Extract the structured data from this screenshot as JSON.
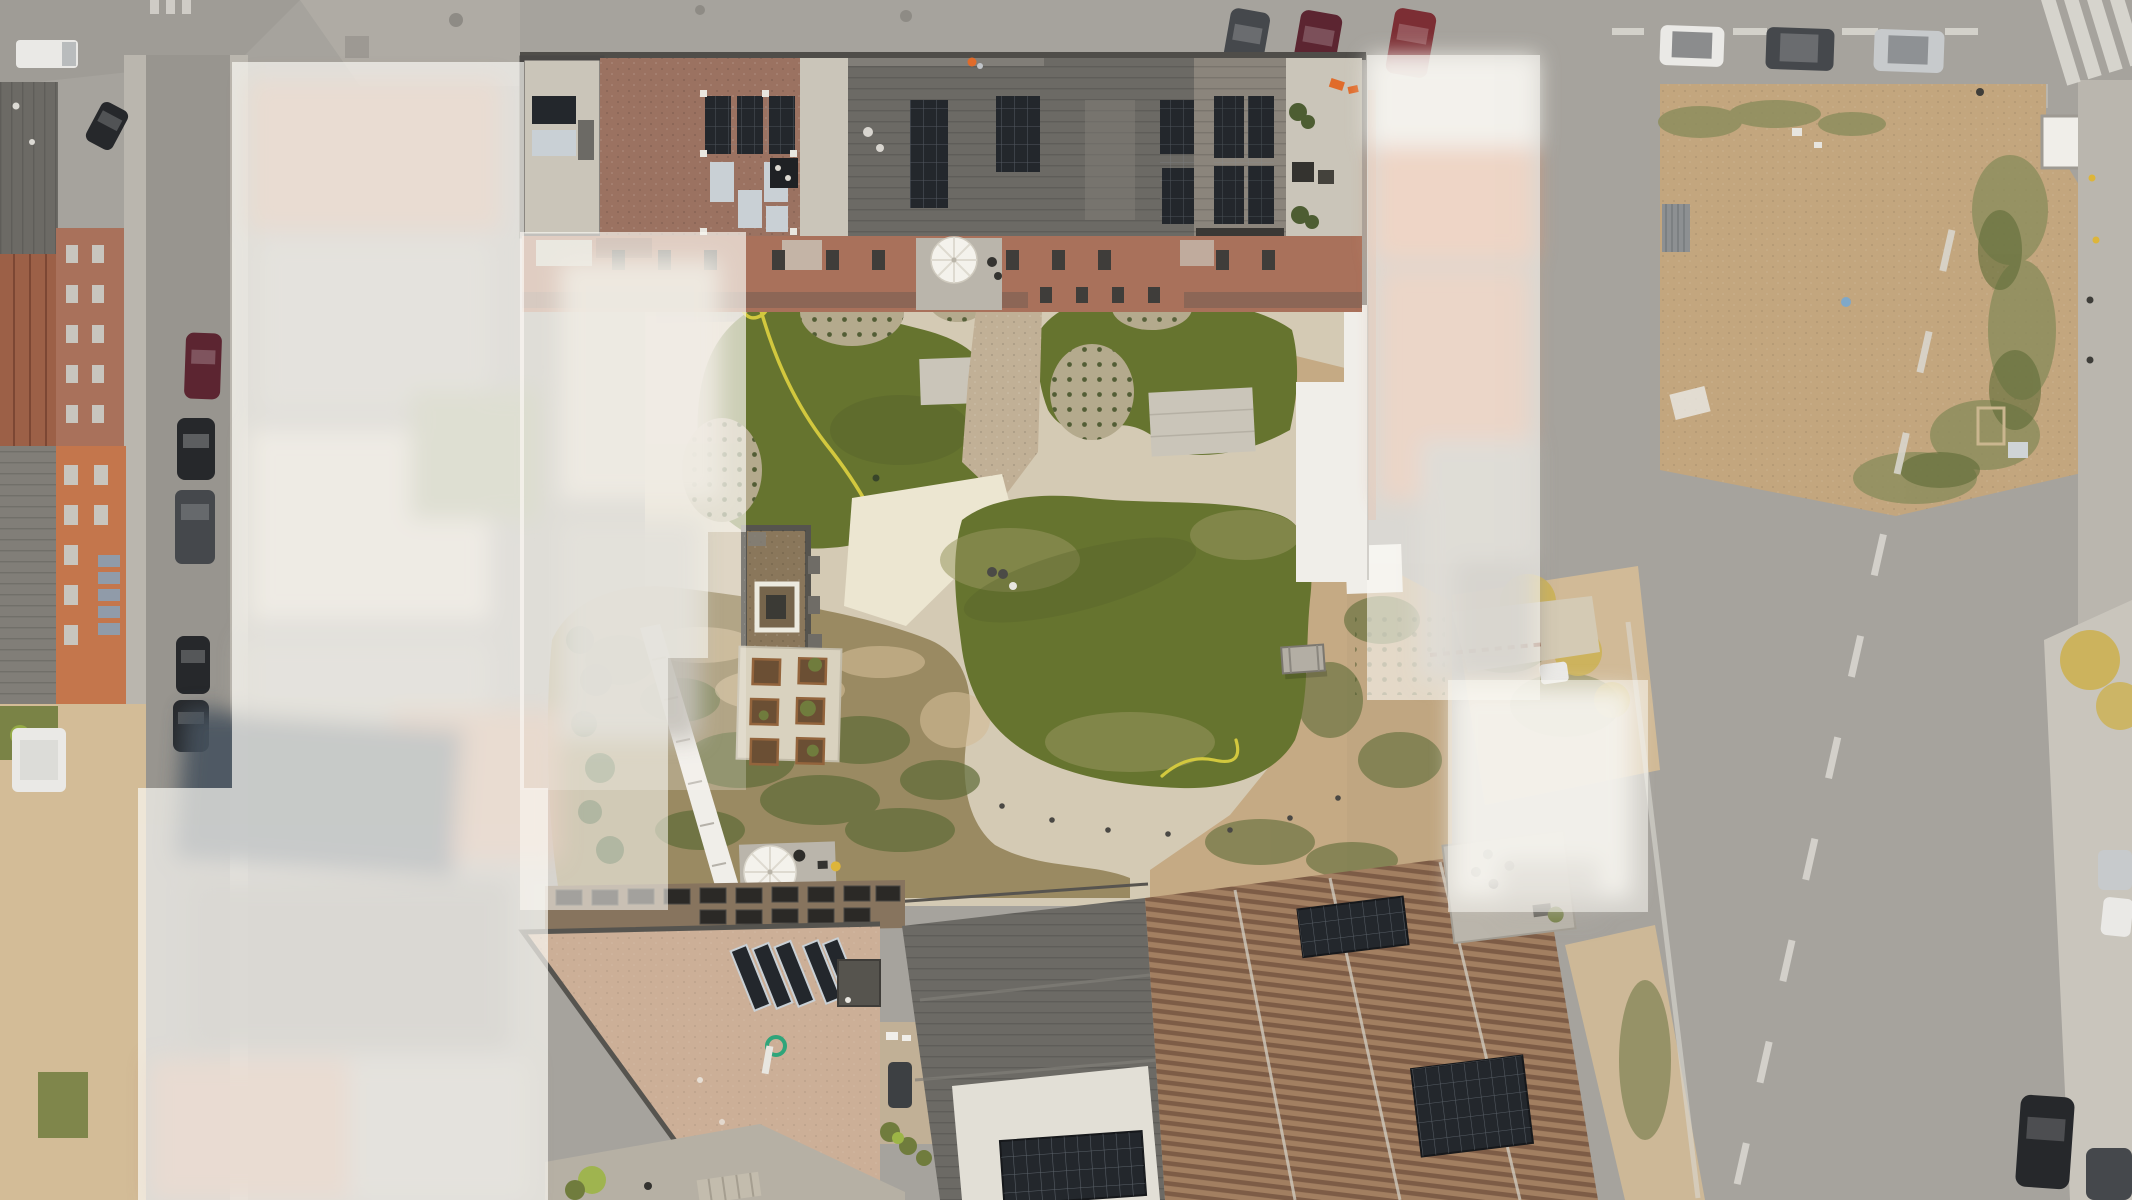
{
  "meta": {
    "image_type": "aerial-drone-orthophoto",
    "subject": "residential courtyard development with solar-panel roofs",
    "treatment": "central property sharp; neighbouring parcels blurred and whitened"
  },
  "objects": {
    "parked_cars_left_street": 5,
    "parked_cars_top_right_row": 3,
    "angle_parked_cars_top_center": 3,
    "cars_on_top_road": 2,
    "cars_bottom_right": 3,
    "white_parasols": 3,
    "lawn_areas": 3,
    "garden_planters": 6,
    "picnic_tables": 1,
    "garden_hoses": 2,
    "zebra_crossings": 1,
    "dirt_lot_containers": 1
  },
  "palette": {
    "asphalt": "#a6a39d",
    "asphalt_dark": "#98958f",
    "sidewalk": "#bab6ae",
    "sidewalk_light": "#c9c5bc",
    "dirt": "#c3a67e",
    "dirt_light": "#d3bc97",
    "scruff": "#8e8e5e",
    "weed": "#5f6c38",
    "lawn": "#66742f",
    "lawn_dark": "#55622a",
    "lawn_dry": "#97965f",
    "path": "#d4cab4",
    "path_bright": "#ece6d1",
    "path_gravel": "#c1b096",
    "island": "#b4aa8d",
    "island_dot": "#47542b",
    "roof_dark": "#6c6a65",
    "roof_mid": "#817e78",
    "roof_pale": "#cac5b9",
    "roof_red": "#9b7261",
    "roof_tan": "#ccaf97",
    "brown_band": "#87745e",
    "skylight": "#2b2926",
    "stripe_a": "#a27f61",
    "stripe_b": "#7d5c46",
    "solar": "#23272c",
    "solar_grid": "#8e969d",
    "solar_silver": "#c9d0d5",
    "white_wall": "#f0eee9",
    "white_roof": "#e2dfd6",
    "haze": "#faf8f3",
    "blur_brick": "#c4977e",
    "blur_gray": "#b4b0a8",
    "blur_warm": "#d9d0c3",
    "blur_orange": "#e09a76",
    "blur_white": "#efede7",
    "blur_dark": "#8e8b84",
    "blur_green": "#9da380",
    "blur_solar": "#46525f",
    "car_white": "#eae9e6",
    "car_silver": "#c7cacc",
    "car_gray": "#45484c",
    "car_black": "#26282b",
    "car_maroon": "#5c2531",
    "car_red": "#7c2e34",
    "marking": "#dbd9d2",
    "parasol": "#f4f2ec",
    "hose": "#d2c83e",
    "tree_yellow": "#ccb257",
    "tree_green": "#707c3d",
    "bush": "#4d5d32",
    "bush_bright": "#9cb546",
    "terrace": "#bab5ab",
    "furniture": "#343330",
    "brick": "#a9715b",
    "window": "#3f3d3a",
    "glass": "#c8c5be",
    "orange_facade": "#c4764c",
    "orange_hi": "#e06b2a",
    "equip_green": "#2fa57a",
    "container": "#8d9092",
    "rust": "#8a4a2e",
    "blue_bit": "#7fa8c9",
    "safety_yellow": "#ddb53a",
    "pad": "#d9d2bf",
    "planter_wood": "#6b4f34",
    "planter_edge": "#93643c",
    "garden_base": "#9a8a62",
    "street_pale": "#b6b0a4",
    "pavilion_fill": "#8a775b",
    "pavilion_inner": "#76654c",
    "roof_seam_dark": "#56544f"
  }
}
